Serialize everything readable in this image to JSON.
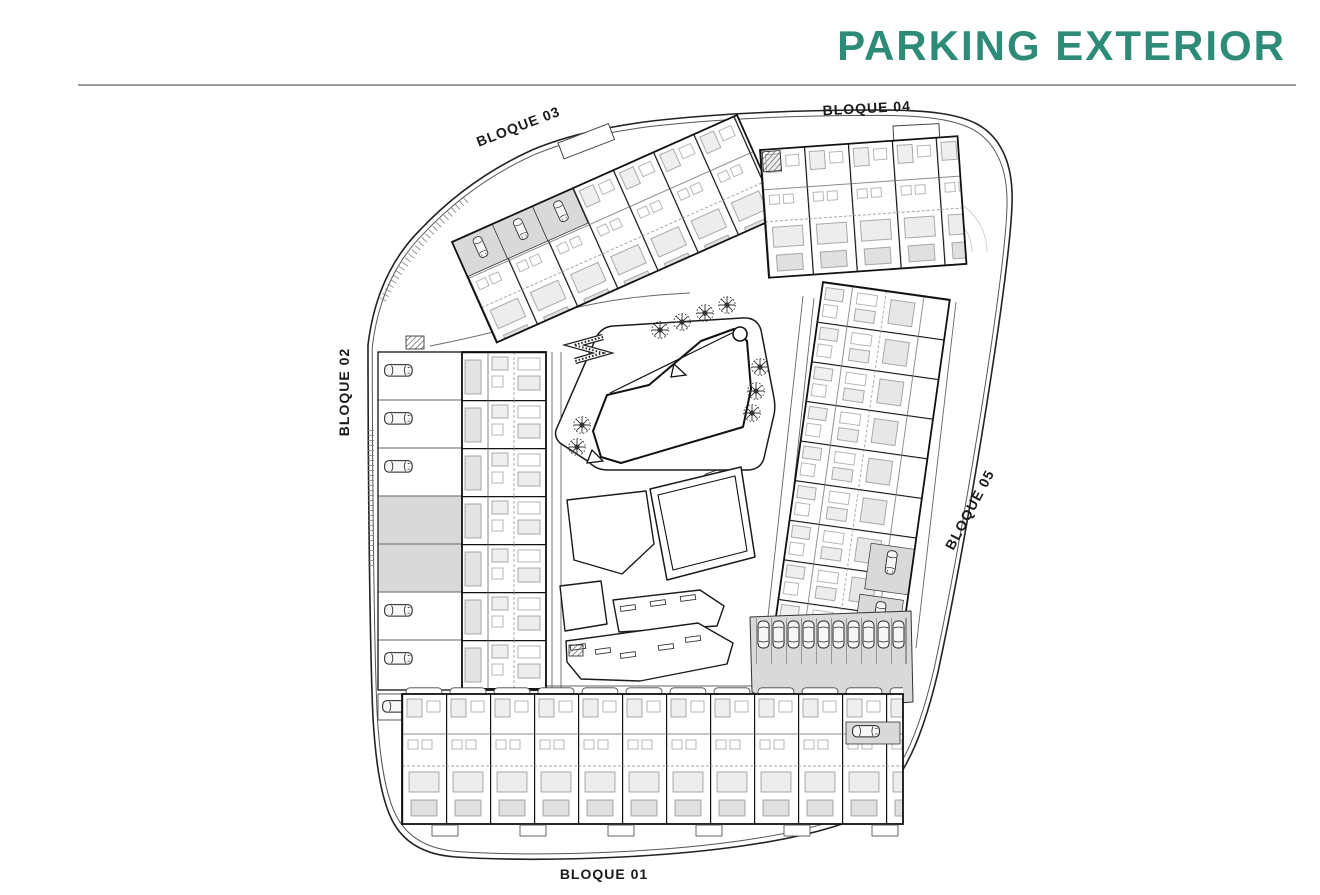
{
  "header": {
    "title": "PARKING EXTERIOR"
  },
  "theme": {
    "accent": "#2E8B77",
    "divider": "#9C9C9C",
    "ink": "#1A1A1A",
    "parking_fill": "#D9D9D9"
  },
  "plan": {
    "blocks": [
      {
        "id": "bloque-01",
        "label": "BLOQUE 01"
      },
      {
        "id": "bloque-02",
        "label": "BLOQUE 02"
      },
      {
        "id": "bloque-03",
        "label": "BLOQUE 03"
      },
      {
        "id": "bloque-04",
        "label": "BLOQUE 04"
      },
      {
        "id": "bloque-05",
        "label": "BLOQUE 05"
      }
    ],
    "features": {
      "pools": 2,
      "palm_trees": 9,
      "exterior_parking_stalls": 10,
      "benches": 10
    }
  }
}
